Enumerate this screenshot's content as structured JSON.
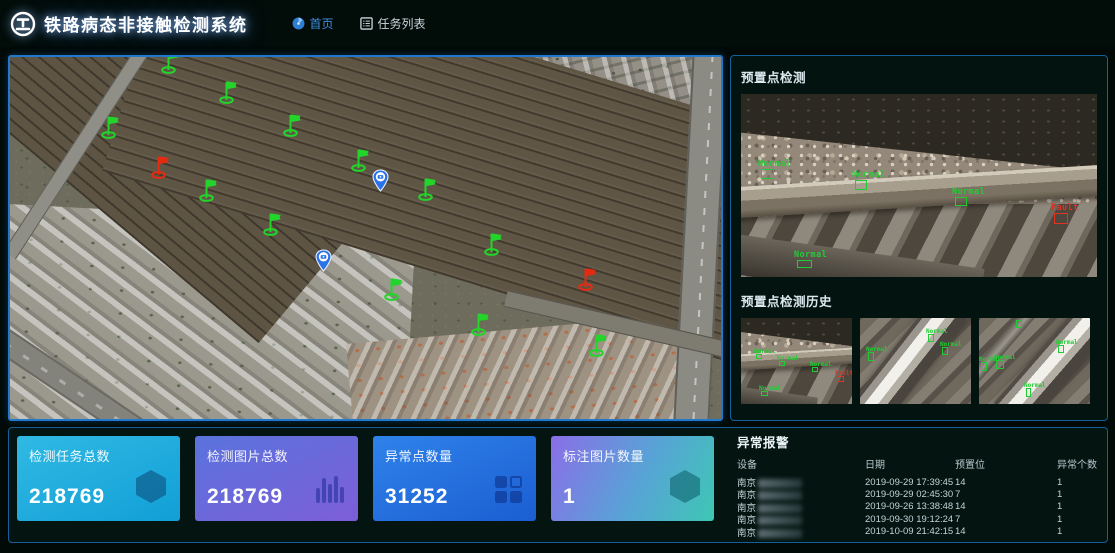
{
  "header": {
    "title": "铁路病态非接触检测系统",
    "nav": [
      {
        "label": "首页",
        "active": true
      },
      {
        "label": "任务列表",
        "active": false
      }
    ]
  },
  "colors": {
    "accent_blue": "#3d8fe0",
    "panel_border": "#1b6fb5",
    "normal_green": "#21cc33",
    "fault_red": "#e23222",
    "card_cyan": "#17a8dc",
    "card_indigo": "#6168da",
    "card_blue": "#2573e0",
    "card_purple_teal": "#7c6ee4"
  },
  "map": {
    "markers": [
      {
        "type": "flag-green",
        "x": 160,
        "y": 13
      },
      {
        "type": "flag-green",
        "x": 218,
        "y": 43
      },
      {
        "type": "flag-green",
        "x": 100,
        "y": 78
      },
      {
        "type": "flag-green",
        "x": 282,
        "y": 76
      },
      {
        "type": "flag-green",
        "x": 350,
        "y": 111
      },
      {
        "type": "flag-green",
        "x": 417,
        "y": 140
      },
      {
        "type": "flag-red",
        "x": 150,
        "y": 118
      },
      {
        "type": "flag-green",
        "x": 198,
        "y": 141
      },
      {
        "type": "flag-green",
        "x": 262,
        "y": 175
      },
      {
        "type": "camera-pin",
        "x": 370,
        "y": 133
      },
      {
        "type": "camera-pin",
        "x": 313,
        "y": 213
      },
      {
        "type": "flag-green",
        "x": 483,
        "y": 195
      },
      {
        "type": "flag-green",
        "x": 383,
        "y": 240
      },
      {
        "type": "flag-red",
        "x": 577,
        "y": 230
      },
      {
        "type": "flag-green",
        "x": 470,
        "y": 275
      },
      {
        "type": "flag-green",
        "x": 588,
        "y": 296
      }
    ]
  },
  "preset_panel": {
    "detection_title": "预置点检测",
    "history_title": "预置点检测历史",
    "detections": [
      {
        "label": "Normal",
        "status": "normal",
        "x": 20,
        "y": 75,
        "w": 13,
        "h": 10
      },
      {
        "label": "Normal",
        "status": "normal",
        "x": 114,
        "y": 86,
        "w": 12,
        "h": 10
      },
      {
        "label": "Normal",
        "status": "normal",
        "x": 214,
        "y": 103,
        "w": 12,
        "h": 9
      },
      {
        "label": "Fault",
        "status": "fault",
        "x": 313,
        "y": 119,
        "w": 14,
        "h": 11
      },
      {
        "label": "Normal",
        "status": "normal",
        "x": 56,
        "y": 166,
        "w": 15,
        "h": 8
      }
    ],
    "history": [
      {
        "variant": "h",
        "boxes": [
          {
            "label": "Normal",
            "status": "normal",
            "x": 15,
            "y": 36,
            "w": 6,
            "h": 5
          },
          {
            "label": "Normal",
            "status": "normal",
            "x": 38,
            "y": 43,
            "w": 6,
            "h": 5
          },
          {
            "label": "Normal",
            "status": "normal",
            "x": 71,
            "y": 49,
            "w": 6,
            "h": 5
          },
          {
            "label": "Fault",
            "status": "fault",
            "x": 96,
            "y": 58,
            "w": 7,
            "h": 6
          },
          {
            "label": "Normal",
            "status": "normal",
            "x": 20,
            "y": 73,
            "w": 7,
            "h": 5
          }
        ]
      },
      {
        "variant": "d",
        "boxes": [
          {
            "label": "Normal",
            "status": "normal",
            "x": 8,
            "y": 34,
            "w": 6,
            "h": 9
          },
          {
            "label": "Normal",
            "status": "normal",
            "x": 68,
            "y": 16,
            "w": 6,
            "h": 8
          },
          {
            "label": "Normal",
            "status": "normal",
            "x": 82,
            "y": 29,
            "w": 6,
            "h": 8
          }
        ]
      },
      {
        "variant": "d2",
        "boxes": [
          {
            "label": "",
            "status": "normal",
            "x": 37,
            "y": 2,
            "w": 6,
            "h": 8
          },
          {
            "label": "Normal",
            "status": "normal",
            "x": 2,
            "y": 44,
            "w": 6,
            "h": 9
          },
          {
            "label": "Normal",
            "status": "normal",
            "x": 17,
            "y": 42,
            "w": 8,
            "h": 9
          },
          {
            "label": "Normal",
            "status": "normal",
            "x": 79,
            "y": 27,
            "w": 6,
            "h": 8
          },
          {
            "label": "Normal",
            "status": "normal",
            "x": 47,
            "y": 70,
            "w": 5,
            "h": 9
          }
        ]
      }
    ]
  },
  "stats": [
    {
      "label": "检测任务总数",
      "value": "218769",
      "icon": "hexagon-icon",
      "gradient": "g-cyan"
    },
    {
      "label": "检测图片总数",
      "value": "218769",
      "icon": "bars-icon",
      "gradient": "g-indigo"
    },
    {
      "label": "异常点数量",
      "value": "31252",
      "icon": "grid-icon",
      "gradient": "g-blue"
    },
    {
      "label": "标注图片数量",
      "value": "1",
      "icon": "hexagon-icon",
      "gradient": "g-pteal"
    }
  ],
  "alarms": {
    "title": "异常报警",
    "columns": [
      "设备",
      "日期",
      "预置位",
      "异常个数"
    ],
    "rows": [
      {
        "device": "南京",
        "date": "2019-09-29 17:39:45",
        "preset": "14",
        "count": "1"
      },
      {
        "device": "南京",
        "date": "2019-09-29 02:45:30",
        "preset": "7",
        "count": "1"
      },
      {
        "device": "南京",
        "date": "2019-09-26 13:38:48",
        "preset": "14",
        "count": "1"
      },
      {
        "device": "南京",
        "date": "2019-09-30 19:12:24",
        "preset": "7",
        "count": "1"
      },
      {
        "device": "南京",
        "date": "2019-10-09 21:42:15",
        "preset": "14",
        "count": "1"
      }
    ]
  }
}
